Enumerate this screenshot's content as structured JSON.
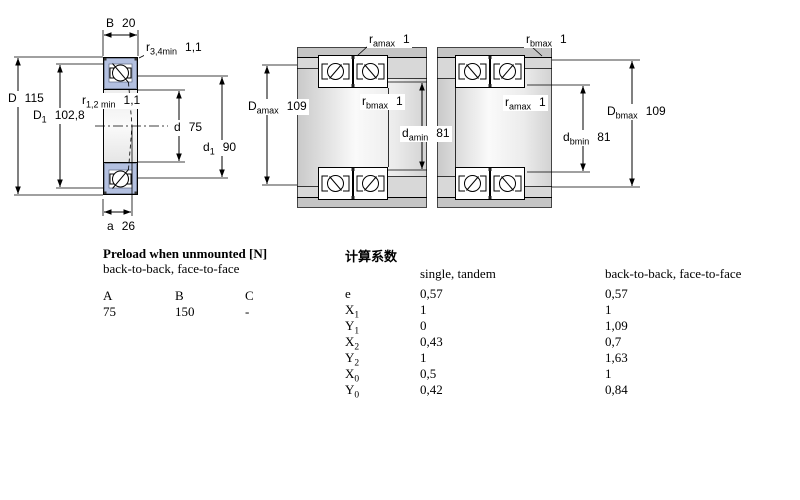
{
  "diagrams": {
    "front_view": {
      "labels": {
        "B": {
          "base": "B",
          "value": "20"
        },
        "r34": {
          "base": "r",
          "sub": "3,4min",
          "value": "1,1"
        },
        "r12": {
          "base": "r",
          "sub": "1,2 min",
          "value": "1,1"
        },
        "D": {
          "base": "D",
          "value": "115"
        },
        "D1": {
          "base": "D",
          "sub": "1",
          "value": "102,8"
        },
        "d": {
          "base": "d",
          "value": "75"
        },
        "d1": {
          "base": "d",
          "sub": "1",
          "value": "90"
        },
        "a": {
          "base": "a",
          "value": "26"
        }
      }
    },
    "mounting_a": {
      "labels": {
        "ramax": {
          "base": "r",
          "sub": "amax",
          "value": "1"
        },
        "Damax": {
          "base": "D",
          "sub": "amax",
          "value": "109"
        },
        "rbmax": {
          "base": "r",
          "sub": "bmax",
          "value": "1"
        },
        "damin": {
          "base": "d",
          "sub": "amin",
          "value": "81"
        }
      }
    },
    "mounting_b": {
      "labels": {
        "rbmax": {
          "base": "r",
          "sub": "bmax",
          "value": "1"
        },
        "ramax": {
          "base": "r",
          "sub": "amax",
          "value": "1"
        },
        "dbmin": {
          "base": "d",
          "sub": "bmin",
          "value": "81"
        },
        "Dbmax": {
          "base": "D",
          "sub": "bmax",
          "value": "109"
        }
      }
    }
  },
  "preload_table": {
    "title": "Preload when unmounted [N]",
    "subtitle": "back-to-back, face-to-face",
    "columns": [
      "A",
      "B",
      "C"
    ],
    "values": [
      "75",
      "150",
      "-"
    ]
  },
  "factors_table": {
    "title": "计算系数",
    "col_single": "single, tandem",
    "col_paired": "back-to-back, face-to-face",
    "rows": [
      {
        "base": "e",
        "sub": "",
        "single": "0,57",
        "paired": "0,57"
      },
      {
        "base": "X",
        "sub": "1",
        "single": "1",
        "paired": "1"
      },
      {
        "base": "Y",
        "sub": "1",
        "single": "0",
        "paired": "1,09"
      },
      {
        "base": "X",
        "sub": "2",
        "single": "0,43",
        "paired": "0,7"
      },
      {
        "base": "Y",
        "sub": "2",
        "single": "1",
        "paired": "1,63"
      },
      {
        "base": "X",
        "sub": "0",
        "single": "0,5",
        "paired": "1"
      },
      {
        "base": "Y",
        "sub": "0",
        "single": "0,42",
        "paired": "0,84"
      }
    ]
  },
  "colors": {
    "bearing_ring_fill": "#b3c0e0",
    "housing_gray": "#c5c5c5",
    "shoulder_gray": "#d8d8d8",
    "line": "#000000"
  }
}
